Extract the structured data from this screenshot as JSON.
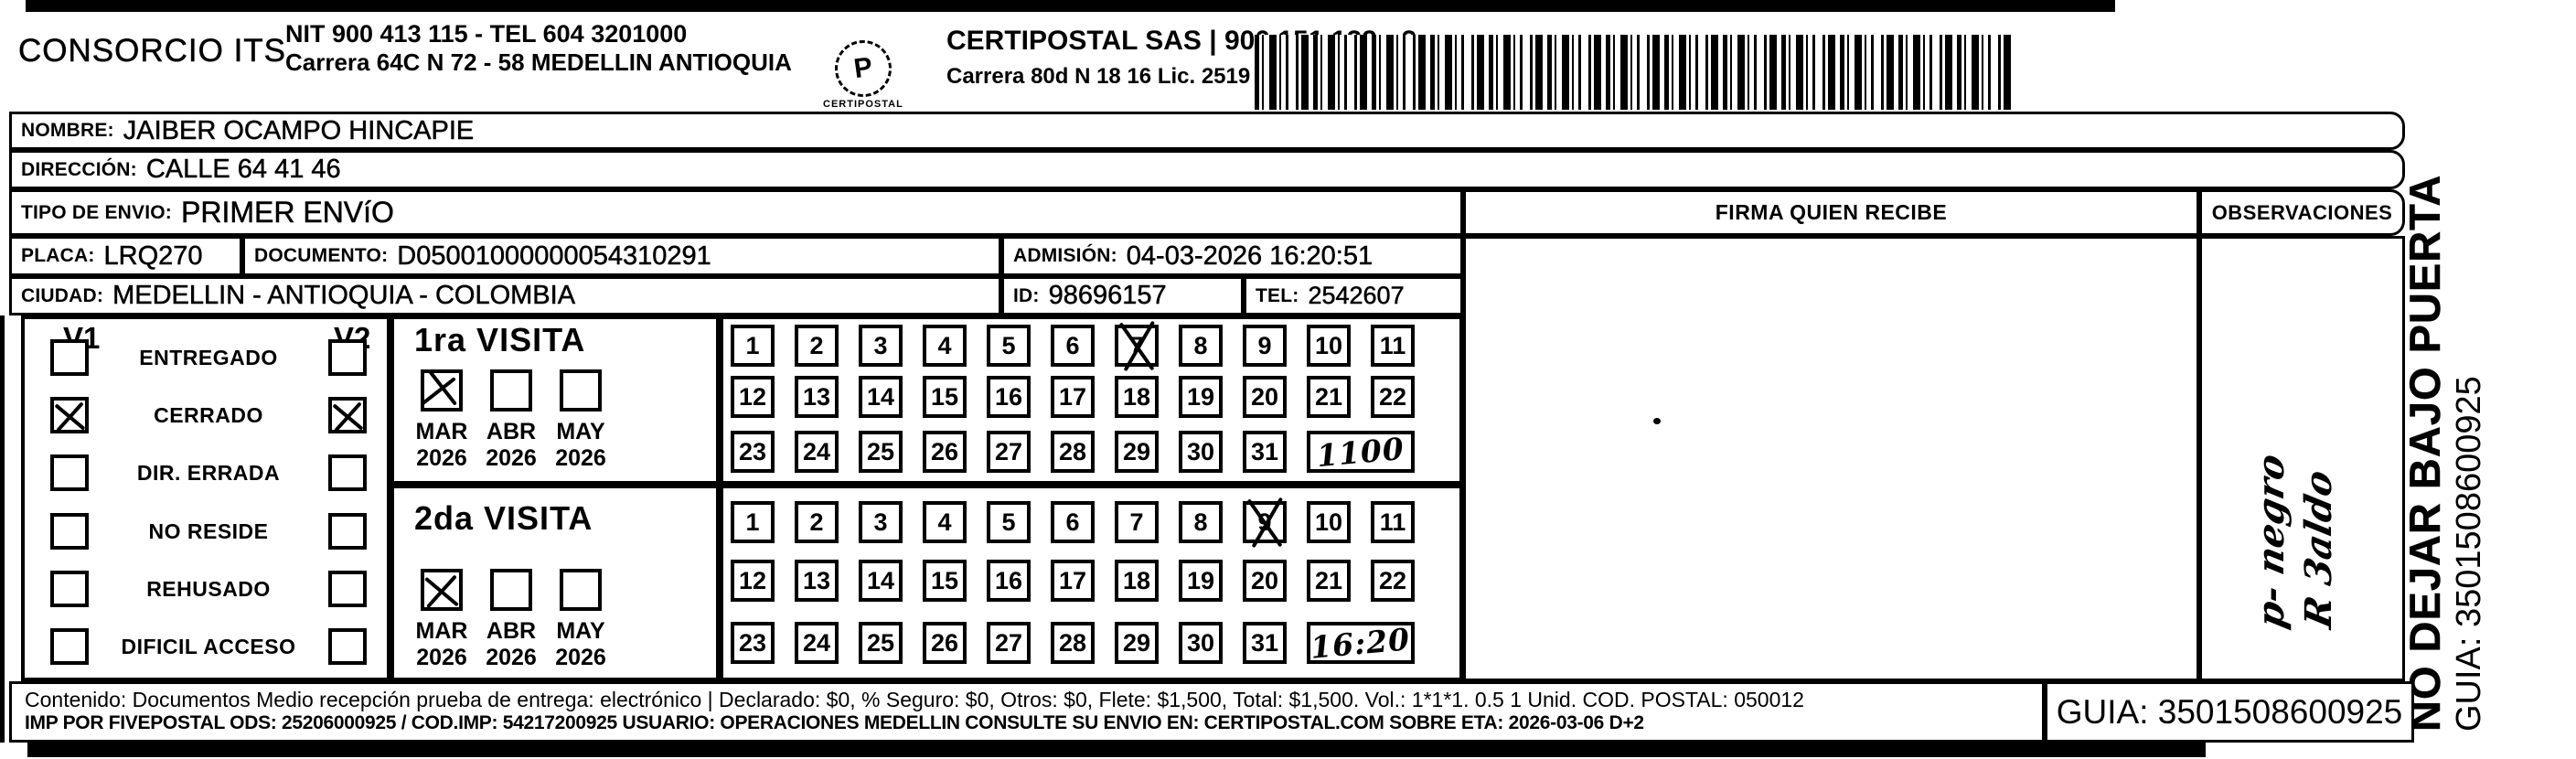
{
  "header": {
    "consorcio": "CONSORCIO ITS",
    "nit_line": "NIT 900 413 115 - TEL 604 3201000",
    "address_line": "Carrera 64C N 72 - 58 MEDELLIN ANTIOQUIA",
    "logo_glyph": "P",
    "logo_text": "CERTIPOSTAL",
    "certipostal_line": "CERTIPOSTAL SAS | 900 151 122 - 2",
    "certipostal_address": "Carrera 80d N 18 16  Lic. 2519 De Octubre 23 De 2015"
  },
  "recipient": {
    "nombre_label": "NOMBRE:",
    "nombre": "JAIBER OCAMPO HINCAPIE",
    "direccion_label": "DIRECCIÓN:",
    "direccion": "CALLE 64  41 46",
    "tipo_label": "TIPO DE ENVIO:",
    "tipo": "PRIMER ENVíO",
    "placa_label": "PLACA:",
    "placa": "LRQ270",
    "documento_label": "DOCUMENTO:",
    "documento": "D05001000000054310291",
    "admision_label": "ADMISIÓN:",
    "admision": "04-03-2026 16:20:51",
    "ciudad_label": "CIUDAD:",
    "ciudad": "MEDELLIN - ANTIOQUIA - COLOMBIA",
    "id_label": "ID:",
    "id": "98696157",
    "tel_label": "TEL:",
    "tel": "2542607"
  },
  "status": {
    "v1_label": "V1",
    "v2_label": "V2",
    "items": [
      {
        "label": "ENTREGADO",
        "v1": false,
        "v2": false
      },
      {
        "label": "CERRADO",
        "v1": true,
        "v2": true
      },
      {
        "label": "DIR. ERRADA",
        "v1": false,
        "v2": false
      },
      {
        "label": "NO RESIDE",
        "v1": false,
        "v2": false
      },
      {
        "label": "REHUSADO",
        "v1": false,
        "v2": false
      },
      {
        "label": "DIFICIL ACCESO",
        "v1": false,
        "v2": false
      }
    ]
  },
  "day_numbers": [
    1,
    2,
    3,
    4,
    5,
    6,
    7,
    8,
    9,
    10,
    11,
    12,
    13,
    14,
    15,
    16,
    17,
    18,
    19,
    20,
    21,
    22,
    23,
    24,
    25,
    26,
    27,
    28,
    29,
    30,
    31
  ],
  "visits": [
    {
      "title": "1ra VISITA",
      "months": [
        {
          "label": "MAR",
          "year": "2026",
          "checked": true
        },
        {
          "label": "ABR",
          "year": "2026",
          "checked": false
        },
        {
          "label": "MAY",
          "year": "2026",
          "checked": false
        }
      ],
      "crossed_day": 7,
      "time_note": "1100"
    },
    {
      "title": "2da VISITA",
      "months": [
        {
          "label": "MAR",
          "year": "2026",
          "checked": true
        },
        {
          "label": "ABR",
          "year": "2026",
          "checked": false
        },
        {
          "label": "MAY",
          "year": "2026",
          "checked": false
        }
      ],
      "crossed_day": 9,
      "time_note": "16:20"
    }
  ],
  "firma": {
    "header": "FIRMA QUIEN RECIBE"
  },
  "observaciones": {
    "header": "OBSERVACIONES",
    "handwriting_line1": "p- negro",
    "handwriting_line2": "R 3aldo"
  },
  "side_note": {
    "line1": "NO DEJAR BAJO PUERTA",
    "line2": "GUIA: 3501508600925"
  },
  "footer": {
    "line1": "Contenido: Documentos Medio recepción prueba de entrega: electrónico | Declarado: $0, % Seguro: $0, Otros: $0, Flete: $1,500, Total: $1,500. Vol.: 1*1*1. 0.5 1 Unid. COD. POSTAL: 050012",
    "line2": "IMP POR FIVEPOSTAL ODS: 25206000925 / COD.IMP: 54217200925 USUARIO: OPERACIONES MEDELLIN CONSULTE SU ENVIO EN: CERTIPOSTAL.COM SOBRE ETA: 2026-03-06 D+2",
    "guia": "GUIA: 3501508600925"
  },
  "colors": {
    "ink": "#000000",
    "paper": "#ffffff"
  }
}
